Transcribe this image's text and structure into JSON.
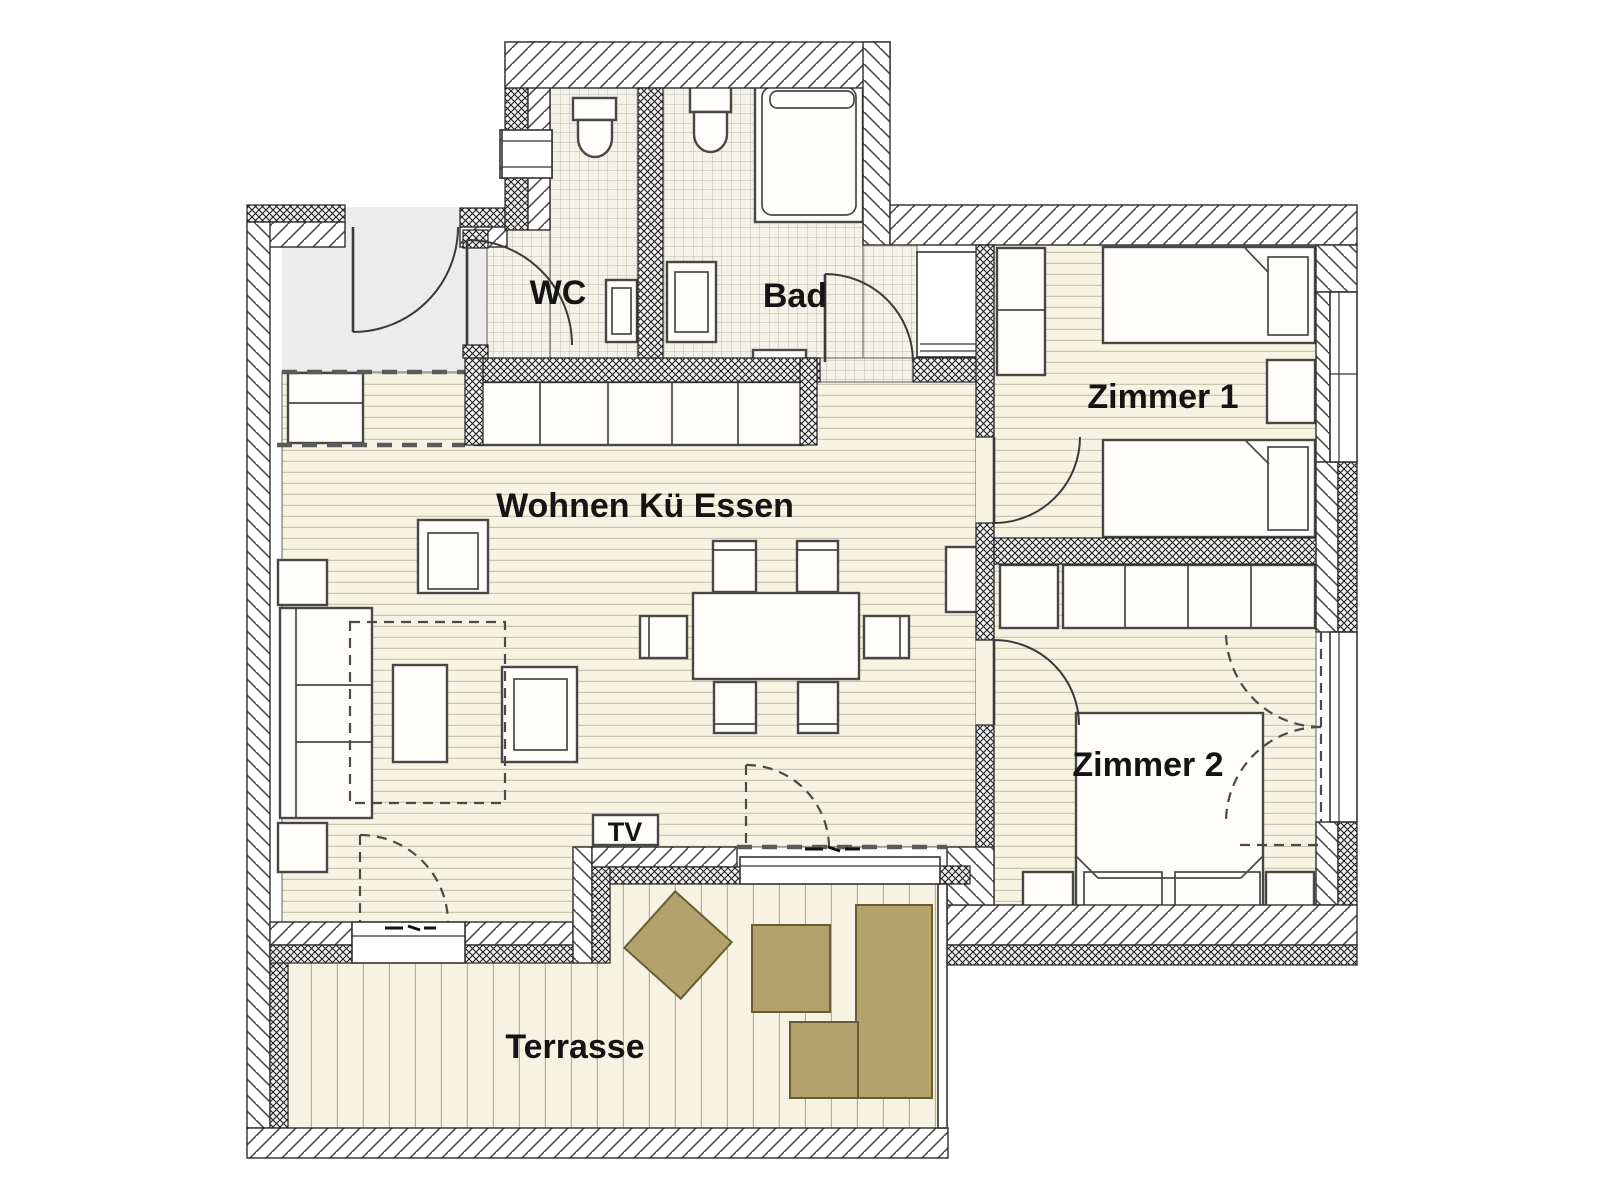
{
  "plan": {
    "type": "apartment-floor-plan",
    "labels": {
      "wc": "WC",
      "bad": "Bad",
      "zimmer1": "Zimmer 1",
      "wohnen": "Wohnen Kü Essen",
      "zimmer2": "Zimmer 2",
      "tv": "TV",
      "terrasse": "Terrasse"
    },
    "colors": {
      "floor_cream": "#f6f3e2",
      "entry_floor": "#ececec",
      "wood_line": "#c9c6b1",
      "tile_grid": "#bcb9a8",
      "deck_line": "#b3b1a1",
      "wall_hatch": "#4d4d4d",
      "terrace_furniture": "#b3a26b",
      "terrace_furniture_border": "#6a5d36",
      "label_text": "#141414"
    },
    "rooms": [
      {
        "id": "wc",
        "furniture": [
          "toilet",
          "sink",
          "window"
        ]
      },
      {
        "id": "bad",
        "furniture": [
          "toilet",
          "bathtub",
          "sink",
          "shower",
          "bath-mat"
        ]
      },
      {
        "id": "wohnen-ku-essen",
        "furniture": [
          "kitchen-counter",
          "tall-cabinet",
          "dining-table",
          "six-chairs",
          "sofa",
          "coffee-table",
          "armchair",
          "armchair",
          "side-table",
          "side-table",
          "rug",
          "tv-board",
          "sideboard"
        ]
      },
      {
        "id": "zimmer1",
        "furniture": [
          "wardrobe",
          "single-bed",
          "single-bed",
          "nightstand"
        ]
      },
      {
        "id": "zimmer2",
        "furniture": [
          "wardrobe-row",
          "double-bed",
          "nightstand",
          "nightstand"
        ]
      },
      {
        "id": "terrasse",
        "furniture": [
          "rotated-table",
          "stool",
          "lounger",
          "stool"
        ]
      }
    ]
  }
}
